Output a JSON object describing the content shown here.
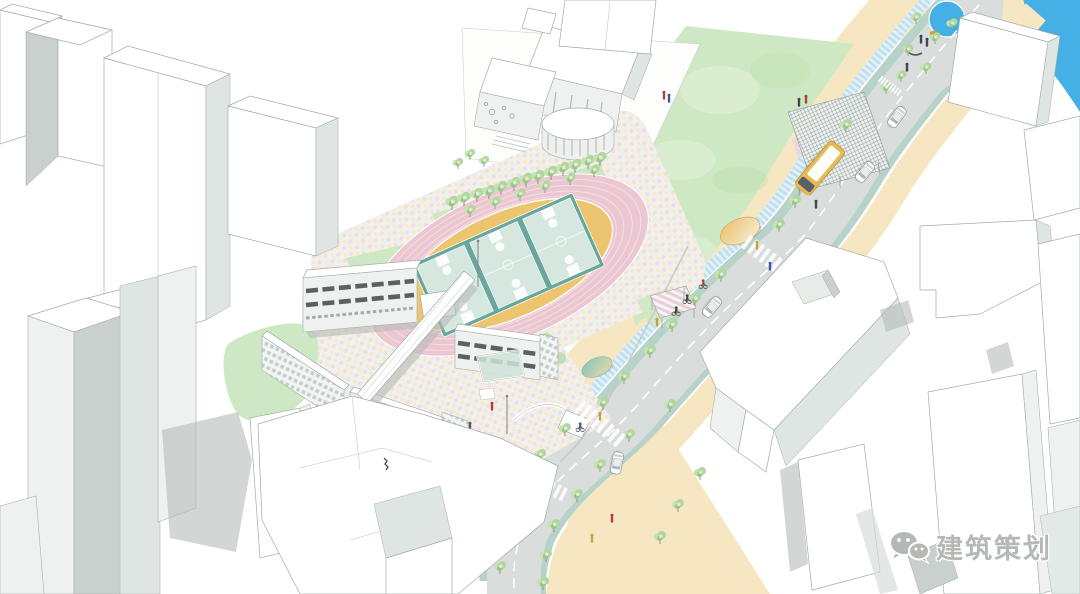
{
  "page": {
    "background": "#ffffff",
    "description": "Axonometric urban-design illustration: a school campus with pink running track, three basketball courts, white teaching-building wings linked by a bridge, a historic building on a watercolor lawn, and a renovated street with bike lanes, bus stop canopy, crosswalks, circular pond and waterfront, surrounded by plain white city blocks"
  },
  "watermark": {
    "text": "建筑策划",
    "icon": "wechat-logo-icon",
    "color": "#b4b9b6"
  },
  "colors": {
    "road_gray": "#d9dddb",
    "sidewalk_tan": "#f6e7c2",
    "strip_teal": "#b7d2c8",
    "bike_blue": "#bfdfee",
    "water_blue": "#45b0e5",
    "lawn_green": "#cfe8c4",
    "lawn_light": "#e4f2d9",
    "track_pink": "#ecc6d1",
    "track_lane": "#f5dde4",
    "infield_yellow": "#ecc56e",
    "court_teal": "#69a79c",
    "court_light": "#d6e7e0",
    "confetti_pink": "#f2d8e1",
    "confetti_yellow": "#f6e8c9",
    "confetti_blue": "#d9e8f2",
    "confetti_mint": "#dcede0",
    "bldg_white": "#ffffff",
    "bldg_light": "#eef1f0",
    "bldg_mid": "#dfe5e2",
    "bldg_dark": "#c9d0cd",
    "shadow_gray": "#b5bbb8",
    "outline_gray": "#a2aca9",
    "bus_yellow": "#e9b94d",
    "tree_green": "#b2d69e",
    "tree_dark": "#9cc48e",
    "people_red": "#b24040",
    "people_blue": "#3a5fa0",
    "people_yellow": "#c9a23a",
    "watermark_gray": "#b4b9b6"
  },
  "counts": {
    "basketball_courts": 3,
    "buses": 1,
    "cars": 4,
    "crosswalks": 3,
    "canopy_discs": 3
  },
  "scene_elements": [
    "context-city-blocks",
    "school-campus",
    "running-track",
    "basketball-courts",
    "teaching-building-wings",
    "connecting-bridge",
    "confetti-paving-plaza",
    "historic-building",
    "great-lawn",
    "tree-row",
    "street",
    "dashed-centerline",
    "bike-lane",
    "planting-strips",
    "sidewalks",
    "zebra-crosswalks",
    "bus-stop-lattice-canopy",
    "yellow-bus",
    "white-cars",
    "cyclists",
    "pedestrians",
    "pergola",
    "canopy-discs",
    "entrance-plaza",
    "circular-pond",
    "beach-strip",
    "waterfront-canal",
    "wechat-watermark"
  ]
}
